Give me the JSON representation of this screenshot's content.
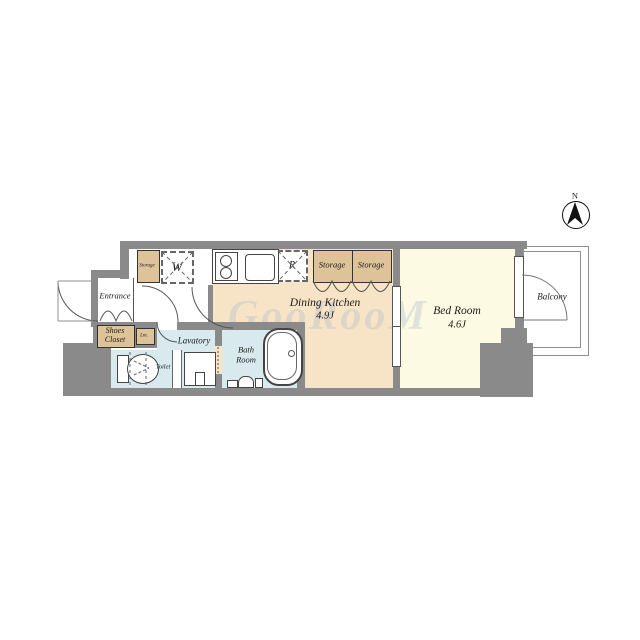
{
  "plan": {
    "title": "apartment-floor-plan",
    "watermark": "GooRooM",
    "compass": {
      "label": "N"
    },
    "rooms": {
      "entrance": {
        "label": "Entrance"
      },
      "shoes_closet": {
        "line1": "Shoes",
        "line2": "Closet"
      },
      "linen": {
        "label": "Lm."
      },
      "storage_entry": {
        "label": "Storage"
      },
      "washer": {
        "label": "W"
      },
      "refrigerator": {
        "label": "R"
      },
      "storage_1": {
        "label": "Storage"
      },
      "storage_2": {
        "label": "Storage"
      },
      "dining_kitchen": {
        "label": "Dining Kitchen",
        "size": "4.9J"
      },
      "bed_room": {
        "label": "Bed Room",
        "size": "4.6J"
      },
      "balcony": {
        "label": "Balcony"
      },
      "lavatory": {
        "label": "Lavatory"
      },
      "bath_room": {
        "line1": "Bath",
        "line2": "Room"
      },
      "toilet": {
        "label": "Toilet"
      }
    },
    "colors": {
      "wall": "#8a8a8a",
      "dk-floor": "#f7e4c6",
      "bed-floor": "#fcfae3",
      "wet-floor": "#d8eaee",
      "storage": "#dec298"
    }
  }
}
